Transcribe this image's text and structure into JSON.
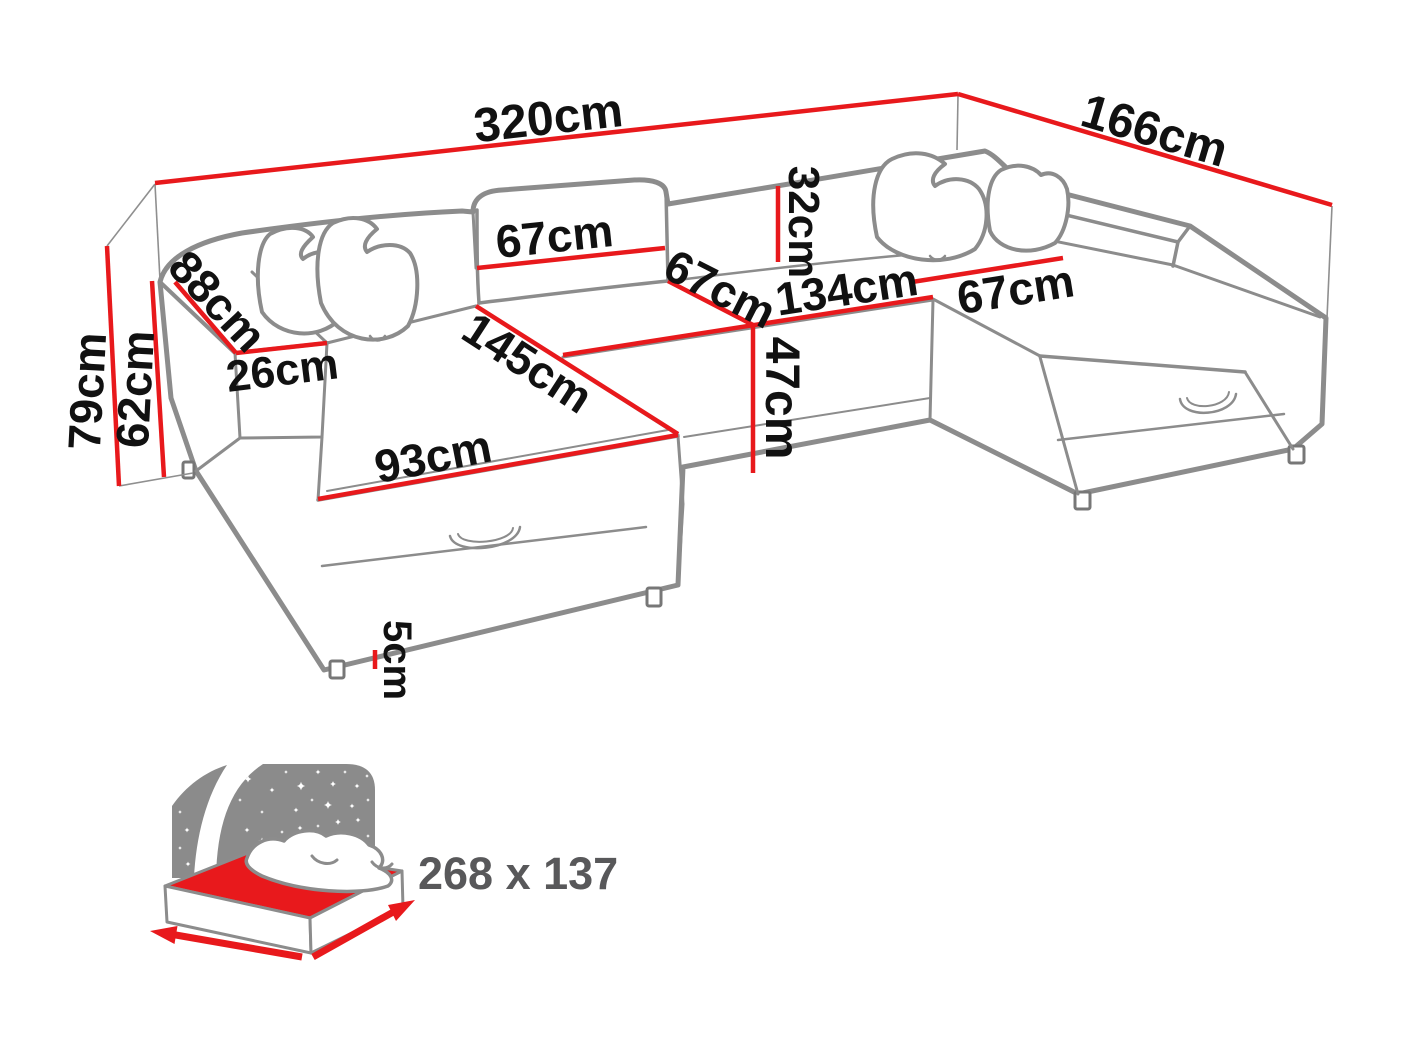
{
  "diagram": {
    "title": "U-shaped corner sofa bed dimension diagram",
    "dimensions": [
      {
        "id": "total-width",
        "value": "320",
        "unit": "cm"
      },
      {
        "id": "total-depth",
        "value": "166",
        "unit": "cm"
      },
      {
        "id": "total-height",
        "value": "79",
        "unit": "cm"
      },
      {
        "id": "armrest-height",
        "value": "62",
        "unit": "cm"
      },
      {
        "id": "armrest-length",
        "value": "88",
        "unit": "cm"
      },
      {
        "id": "armrest-width",
        "value": "26",
        "unit": "cm"
      },
      {
        "id": "backrest-cushion-width",
        "value": "67",
        "unit": "cm"
      },
      {
        "id": "center-seat-width",
        "value": "67",
        "unit": "cm"
      },
      {
        "id": "seat-section-length",
        "value": "134",
        "unit": "cm"
      },
      {
        "id": "right-seat-width",
        "value": "67",
        "unit": "cm"
      },
      {
        "id": "backrest-cushion-height",
        "value": "32",
        "unit": "cm"
      },
      {
        "id": "seat-height",
        "value": "47",
        "unit": "cm"
      },
      {
        "id": "chaise-length",
        "value": "145",
        "unit": "cm"
      },
      {
        "id": "chaise-front-width",
        "value": "93",
        "unit": "cm"
      },
      {
        "id": "leg-height",
        "value": "5",
        "unit": "cm"
      }
    ],
    "sleeping_area": {
      "size_label": "268 x 137"
    },
    "colors": {
      "dimension_red": "#e8191c",
      "outline_gray": "#8c8c8c",
      "label_black": "#111111",
      "icon_gray": "#8b8b8b",
      "icon_text_gray": "#58585a"
    }
  }
}
